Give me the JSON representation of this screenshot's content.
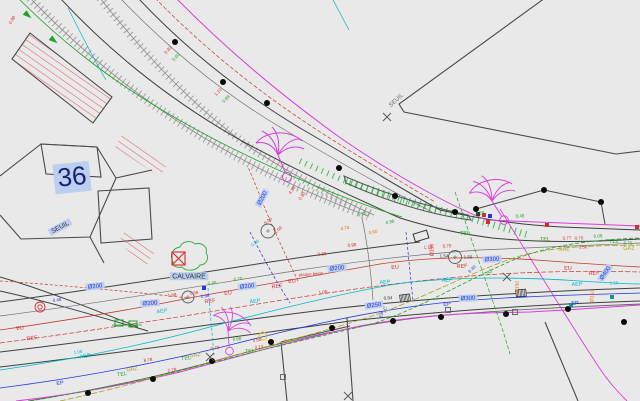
{
  "plan": {
    "parcel_number": "36",
    "threshold_label": "SEUIL",
    "monument_label": "CALVAIRE",
    "note_label": "plaque beige"
  },
  "palette": {
    "background": "#e9e9e9",
    "ink": "#3f3f3f",
    "building": "#4a4a4a",
    "red": "#d02f2f",
    "hatch_red": "#e06060",
    "green": "#1fa32a",
    "cyan": "#00b7c9",
    "blue": "#2438d8",
    "olive": "#a8a020",
    "orange": "#e0761a",
    "magenta": "#d83fd8",
    "dark": "#333333",
    "gray": "#6b6b6b",
    "navy": "#16246e",
    "teal": "#0a9c8f",
    "labelbg": "#b9cdf0",
    "wall": "#9a9a9a",
    "dot": "#0a0a0a",
    "yellow": "#d8ce00"
  },
  "labels": [
    {
      "t": "36",
      "x": 72,
      "y": 177,
      "c": "navy",
      "s": 26,
      "r": -6,
      "bg": true,
      "f": "serif"
    },
    {
      "t": "SEUIL",
      "x": 60,
      "y": 227,
      "c": "dark",
      "s": 6.5,
      "r": -28,
      "bg": true
    },
    {
      "t": "SEUIL",
      "x": 396,
      "y": 100,
      "c": "gray",
      "s": 6,
      "r": -42
    },
    {
      "t": "CALVAIRE",
      "x": 189,
      "y": 276,
      "c": "dark",
      "s": 7,
      "r": 0,
      "bg": true
    },
    {
      "t": "Ø200",
      "x": 95,
      "y": 286,
      "c": "blue",
      "s": 6,
      "r": -6,
      "bg": true
    },
    {
      "t": "Ø200",
      "x": 150,
      "y": 303,
      "c": "blue",
      "s": 6,
      "r": -4,
      "bg": true
    },
    {
      "t": "Ø200",
      "x": 247,
      "y": 286,
      "c": "blue",
      "s": 6,
      "r": -6,
      "bg": true
    },
    {
      "t": "Ø200",
      "x": 337,
      "y": 268,
      "c": "blue",
      "s": 6,
      "r": -6,
      "bg": true
    },
    {
      "t": "Ø200",
      "x": 262,
      "y": 198,
      "c": "blue",
      "s": 6,
      "r": -62,
      "bg": true
    },
    {
      "t": "Ø300",
      "x": 492,
      "y": 259,
      "c": "blue",
      "s": 6,
      "r": -3,
      "bg": true
    },
    {
      "t": "Ø300",
      "x": 468,
      "y": 298,
      "c": "blue",
      "s": 6,
      "r": -2,
      "bg": true
    },
    {
      "t": "Ø250",
      "x": 374,
      "y": 305,
      "c": "blue",
      "s": 6,
      "r": -8,
      "bg": true
    },
    {
      "t": "Ø400",
      "x": 605,
      "y": 273,
      "c": "blue",
      "s": 6,
      "r": -55,
      "bg": true
    },
    {
      "t": "Ø150",
      "x": 432,
      "y": 250,
      "c": "red",
      "s": 5,
      "r": -90
    },
    {
      "t": "Ø150",
      "x": 592,
      "y": 296,
      "c": "orange",
      "s": 5,
      "r": -85
    },
    {
      "t": "Ø150",
      "x": 517,
      "y": 287,
      "c": "orange",
      "s": 5,
      "r": -88
    },
    {
      "t": "EU",
      "x": 20,
      "y": 328,
      "c": "red",
      "s": 5.5,
      "r": -8
    },
    {
      "t": "EU",
      "x": 228,
      "y": 293,
      "c": "red",
      "s": 5.5,
      "r": -8
    },
    {
      "t": "EU",
      "x": 292,
      "y": 281,
      "c": "red",
      "s": 5.5,
      "r": -6
    },
    {
      "t": "EU",
      "x": 395,
      "y": 267,
      "c": "red",
      "s": 5.5,
      "r": -4
    },
    {
      "t": "EU",
      "x": 568,
      "y": 268,
      "c": "red",
      "s": 5.5,
      "r": -2
    },
    {
      "t": "REF",
      "x": 32,
      "y": 338,
      "c": "red",
      "s": 5.5,
      "r": -8
    },
    {
      "t": "REF",
      "x": 210,
      "y": 301,
      "c": "red",
      "s": 5.5,
      "r": -8
    },
    {
      "t": "REF",
      "x": 277,
      "y": 286,
      "c": "red",
      "s": 5.5,
      "r": -6
    },
    {
      "t": "REF",
      "x": 462,
      "y": 266,
      "c": "red",
      "s": 5.5,
      "r": -3
    },
    {
      "t": "REF",
      "x": 594,
      "y": 273,
      "c": "red",
      "s": 5.5,
      "r": -2
    },
    {
      "t": "AEP",
      "x": 85,
      "y": 356,
      "c": "cyan",
      "s": 5.5,
      "r": -10
    },
    {
      "t": "AEP",
      "x": 162,
      "y": 311,
      "c": "cyan",
      "s": 5.5,
      "r": -8
    },
    {
      "t": "AEP",
      "x": 255,
      "y": 301,
      "c": "cyan",
      "s": 5.5,
      "r": -7
    },
    {
      "t": "AEP",
      "x": 385,
      "y": 282,
      "c": "cyan",
      "s": 5.5,
      "r": -4
    },
    {
      "t": "AEP",
      "x": 447,
      "y": 280,
      "c": "cyan",
      "s": 5.5,
      "r": -3
    },
    {
      "t": "AEP",
      "x": 577,
      "y": 284,
      "c": "cyan",
      "s": 5.5,
      "r": -2
    },
    {
      "t": "EP",
      "x": 60,
      "y": 383,
      "c": "blue",
      "s": 5.5,
      "r": -8
    },
    {
      "t": "EP",
      "x": 447,
      "y": 304,
      "c": "blue",
      "s": 5.5,
      "r": -3
    },
    {
      "t": "EP",
      "x": 575,
      "y": 303,
      "c": "blue",
      "s": 5.5,
      "r": -2
    },
    {
      "t": "EP_C",
      "x": 383,
      "y": 312,
      "c": "blue",
      "s": 4.5,
      "r": -60
    },
    {
      "t": "GAZ",
      "x": 132,
      "y": 369,
      "c": "olive",
      "s": 5.5,
      "r": -9
    },
    {
      "t": "GAZ",
      "x": 195,
      "y": 355,
      "c": "olive",
      "s": 5.5,
      "r": -8
    },
    {
      "t": "GAZ",
      "x": 289,
      "y": 341,
      "c": "olive",
      "s": 5.5,
      "r": -6
    },
    {
      "t": "GAZ",
      "x": 564,
      "y": 249,
      "c": "olive",
      "s": 5.5,
      "r": -2
    },
    {
      "t": "GAZ",
      "x": 629,
      "y": 248,
      "c": "olive",
      "s": 5.5,
      "r": -2
    },
    {
      "t": "TEL",
      "x": 122,
      "y": 374,
      "c": "green",
      "s": 5.5,
      "r": -9
    },
    {
      "t": "TEL",
      "x": 186,
      "y": 358,
      "c": "green",
      "s": 5.5,
      "r": -8
    },
    {
      "t": "TEL",
      "x": 250,
      "y": 351,
      "c": "green",
      "s": 5.5,
      "r": -7
    },
    {
      "t": "TEL",
      "x": 465,
      "y": 233,
      "c": "green",
      "s": 5.5,
      "r": -3
    },
    {
      "t": "TEL",
      "x": 545,
      "y": 239,
      "c": "green",
      "s": 5.5,
      "r": -2
    },
    {
      "t": "TEL",
      "x": 614,
      "y": 241,
      "c": "green",
      "s": 5.5,
      "r": -2
    },
    {
      "t": "TEL",
      "x": 490,
      "y": 272,
      "c": "green",
      "s": 4.5,
      "r": -70
    },
    {
      "t": "plaque beige",
      "x": 311,
      "y": 274,
      "c": "red",
      "s": 4.2,
      "r": -4
    },
    {
      "t": "1.68",
      "x": 172,
      "y": 295,
      "c": "red",
      "s": 4.5,
      "r": -8
    },
    {
      "t": "1.58",
      "x": 194,
      "y": 293,
      "c": "red",
      "s": 4.5,
      "r": -8
    },
    {
      "t": "1.18",
      "x": 428,
      "y": 247,
      "c": "red",
      "s": 4.5,
      "r": -4
    },
    {
      "t": "0.70",
      "x": 447,
      "y": 246,
      "c": "red",
      "s": 4.5,
      "r": -4
    },
    {
      "t": "0.77",
      "x": 567,
      "y": 238,
      "c": "red",
      "s": 4.5,
      "r": -2
    },
    {
      "t": "0.70",
      "x": 579,
      "y": 238,
      "c": "red",
      "s": 4.5,
      "r": -2
    },
    {
      "t": "0.50",
      "x": 583,
      "y": 247,
      "c": "red",
      "s": 4.5,
      "r": -2
    },
    {
      "t": "5.06",
      "x": 268,
      "y": 221,
      "c": "red",
      "s": 4.5,
      "r": -40
    },
    {
      "t": "1.08",
      "x": 278,
      "y": 230,
      "c": "red",
      "s": 4.5,
      "r": -40
    },
    {
      "t": "0.98",
      "x": 352,
      "y": 245,
      "c": "red",
      "s": 4.5,
      "r": -5
    },
    {
      "t": "0.80",
      "x": 322,
      "y": 254,
      "c": "red",
      "s": 4.5,
      "r": -5
    },
    {
      "t": "1.00",
      "x": 323,
      "y": 292,
      "c": "red",
      "s": 4.5,
      "r": -5
    },
    {
      "t": "8.78",
      "x": 148,
      "y": 360,
      "c": "red",
      "s": 4.5,
      "r": -9
    },
    {
      "t": "0.70",
      "x": 215,
      "y": 348,
      "c": "red",
      "s": 4.5,
      "r": -8
    },
    {
      "t": "2.78",
      "x": 172,
      "y": 370,
      "c": "red",
      "s": 4.5,
      "r": -9
    },
    {
      "t": "0.60",
      "x": 257,
      "y": 340,
      "c": "red",
      "s": 4.5,
      "r": -7
    },
    {
      "t": "2.12",
      "x": 259,
      "y": 347,
      "c": "red",
      "s": 4.5,
      "r": -7
    },
    {
      "t": "4.98",
      "x": 292,
      "y": 190,
      "c": "red",
      "s": 4.5,
      "r": -55
    },
    {
      "t": "0.90",
      "x": 302,
      "y": 196,
      "c": "red",
      "s": 4.5,
      "r": -55
    },
    {
      "t": "0.82",
      "x": 168,
      "y": 50,
      "c": "red",
      "s": 4.5,
      "r": -48
    },
    {
      "t": "1.10",
      "x": 218,
      "y": 92,
      "c": "red",
      "s": 4.5,
      "r": -46
    },
    {
      "t": "0.98",
      "x": 12,
      "y": 20,
      "c": "red",
      "s": 4.5,
      "r": -60
    },
    {
      "t": "6.08",
      "x": 598,
      "y": 236,
      "c": "green",
      "s": 4.5,
      "r": -2
    },
    {
      "t": "6.70",
      "x": 628,
      "y": 243,
      "c": "green",
      "s": 4.5,
      "r": -2
    },
    {
      "t": "0.75",
      "x": 362,
      "y": 214,
      "c": "green",
      "s": 4.5,
      "r": -15
    },
    {
      "t": "0.98",
      "x": 390,
      "y": 222,
      "c": "green",
      "s": 4.5,
      "r": -12
    },
    {
      "t": "0.40",
      "x": 212,
      "y": 283,
      "c": "green",
      "s": 4.5,
      "r": -8
    },
    {
      "t": "0.70",
      "x": 238,
      "y": 279,
      "c": "green",
      "s": 4.5,
      "r": -8
    },
    {
      "t": "0.58",
      "x": 480,
      "y": 213,
      "c": "green",
      "s": 4.5,
      "r": -5
    },
    {
      "t": "0.48",
      "x": 520,
      "y": 216,
      "c": "green",
      "s": 4.5,
      "r": -4
    },
    {
      "t": "0.68",
      "x": 237,
      "y": 339,
      "c": "green",
      "s": 4.5,
      "r": -7
    },
    {
      "t": "0.60",
      "x": 176,
      "y": 57,
      "c": "green",
      "s": 4.5,
      "r": -48
    },
    {
      "t": "0.98",
      "x": 226,
      "y": 99,
      "c": "green",
      "s": 4.5,
      "r": -46
    },
    {
      "t": "1.06",
      "x": 78,
      "y": 352,
      "c": "cyan",
      "s": 4.5,
      "r": -10
    },
    {
      "t": "0.98",
      "x": 255,
      "y": 243,
      "c": "cyan",
      "s": 4.5,
      "r": -35
    },
    {
      "t": "1.60",
      "x": 614,
      "y": 283,
      "c": "cyan",
      "s": 4.5,
      "r": -2
    },
    {
      "t": "0.48",
      "x": 57,
      "y": 300,
      "c": "blue",
      "s": 4.5,
      "r": -8
    },
    {
      "t": "0.98",
      "x": 205,
      "y": 296,
      "c": "blue",
      "s": 4.5,
      "r": -8
    },
    {
      "t": "6.40",
      "x": 472,
      "y": 269,
      "c": "blue",
      "s": 4.5,
      "r": -45
    },
    {
      "t": "0.78",
      "x": 345,
      "y": 228,
      "c": "orange",
      "s": 4.5,
      "r": -10
    },
    {
      "t": "0.60",
      "x": 373,
      "y": 232,
      "c": "orange",
      "s": 4.5,
      "r": -10
    },
    {
      "t": "1.54",
      "x": 444,
      "y": 256,
      "c": "dark",
      "s": 4.5,
      "r": 0
    },
    {
      "t": "1.56",
      "x": 468,
      "y": 257,
      "c": "dark",
      "s": 4.5,
      "r": 0
    },
    {
      "t": "0.84",
      "x": 388,
      "y": 298,
      "c": "dark",
      "s": 4.5,
      "r": -4
    }
  ],
  "symbols": {
    "tree_dots": [
      [
        175,
        42
      ],
      [
        223,
        82
      ],
      [
        267,
        103
      ],
      [
        339,
        168
      ],
      [
        395,
        196
      ],
      [
        455,
        212
      ]
    ],
    "fence_dots": [
      [
        476,
        209
      ],
      [
        544,
        190
      ],
      [
        601,
        202
      ]
    ],
    "road_dots": [
      [
        88,
        393
      ],
      [
        153,
        379
      ],
      [
        212,
        361
      ],
      [
        271,
        342
      ],
      [
        332,
        328
      ],
      [
        393,
        321
      ],
      [
        441,
        317
      ],
      [
        506,
        314
      ],
      [
        568,
        309
      ],
      [
        624,
        322
      ]
    ],
    "filled_squares": [
      {
        "x": 547,
        "y": 225,
        "c": "red"
      },
      {
        "x": 637,
        "y": 227,
        "c": "red"
      },
      {
        "x": 488,
        "y": 222,
        "c": "red"
      },
      {
        "x": 478,
        "y": 214,
        "c": "dark"
      },
      {
        "x": 484,
        "y": 215,
        "c": "red"
      },
      {
        "x": 490,
        "y": 216,
        "c": "blue"
      },
      {
        "x": 612,
        "y": 297,
        "c": "teal"
      },
      {
        "x": 571,
        "y": 305,
        "c": "teal"
      },
      {
        "x": 204,
        "y": 288,
        "c": "blue"
      }
    ],
    "open_squares": [
      {
        "x": 119,
        "y": 323,
        "w": 8,
        "h": 6,
        "c": "green"
      },
      {
        "x": 133,
        "y": 324,
        "w": 8,
        "h": 6,
        "c": "green"
      },
      {
        "x": 448,
        "y": 310,
        "w": 5,
        "h": 5,
        "c": "gray"
      },
      {
        "x": 515,
        "y": 312,
        "w": 5,
        "h": 5,
        "c": "gray"
      },
      {
        "x": 283,
        "y": 377,
        "w": 5,
        "h": 5,
        "c": "gray"
      },
      {
        "x": 421,
        "y": 236,
        "w": 14,
        "h": 8,
        "c": "dark",
        "r": -17
      }
    ],
    "grates": [
      {
        "x": 405,
        "y": 298,
        "r": -8
      },
      {
        "x": 521,
        "y": 293,
        "r": -5
      }
    ],
    "manholes": [
      {
        "x": 188,
        "y": 297,
        "rad": 6
      },
      {
        "x": 268,
        "y": 231,
        "rad": 7
      },
      {
        "x": 455,
        "y": 257,
        "rad": 6.5
      }
    ],
    "red_circle": {
      "x": 40,
      "y": 307
    },
    "yellow_circle": {
      "x": 263,
      "y": 336,
      "rad": 4
    },
    "crosses": [
      [
        387,
        117
      ],
      [
        348,
        396
      ],
      [
        210,
        357
      ],
      [
        507,
        277
      ]
    ],
    "trees": [
      {
        "x": 278,
        "y": 155,
        "s": 1,
        "r": 0
      },
      {
        "x": 492,
        "y": 201,
        "s": 0.95,
        "r": -10
      },
      {
        "x": 228,
        "y": 331,
        "s": 0.85,
        "r": 18
      }
    ],
    "arrows": [
      {
        "x": 30,
        "y": 17,
        "r": 40
      },
      {
        "x": 56,
        "y": 42,
        "r": 38
      }
    ]
  }
}
